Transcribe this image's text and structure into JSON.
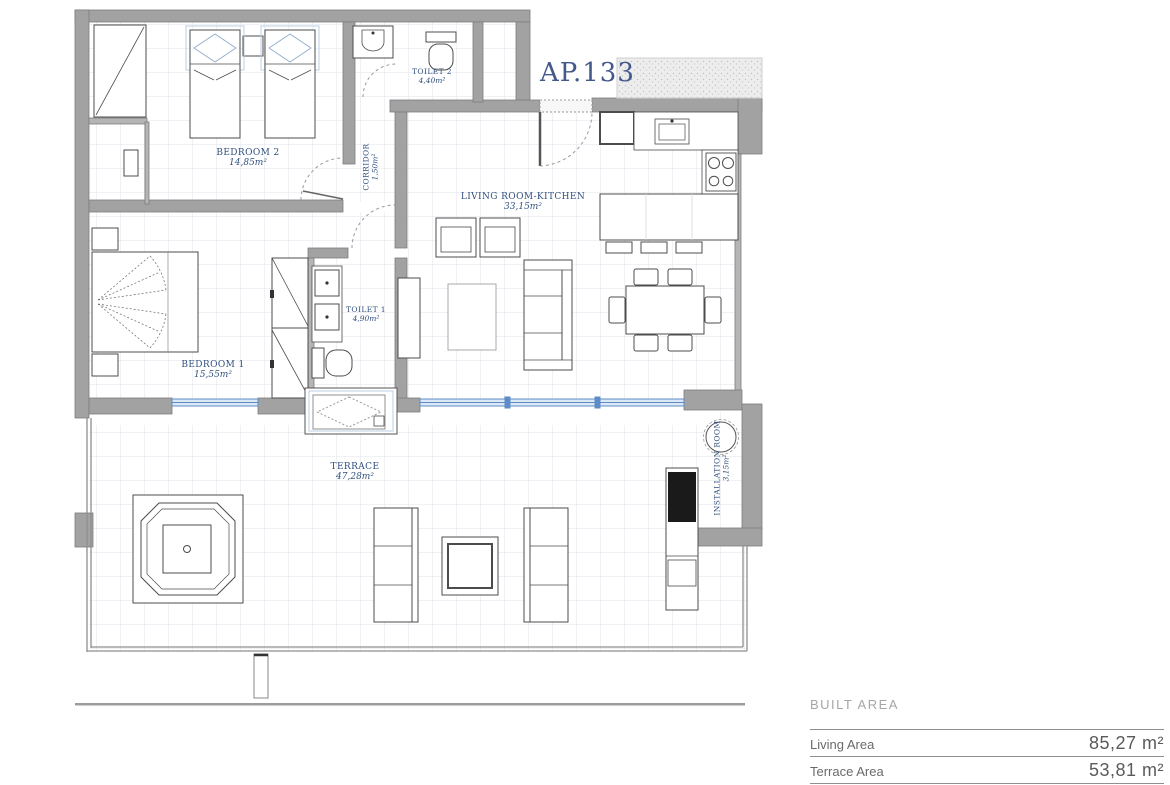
{
  "plan": {
    "apartment_label": "AP.133",
    "rooms": {
      "bedroom2": {
        "name": "BEDROOM 2",
        "area": "14,85m²"
      },
      "toilet2": {
        "name": "TOILET 2",
        "area": "4,40m²"
      },
      "corridor": {
        "name": "CORRIDOR",
        "area": "1,50m²"
      },
      "living": {
        "name": "LIVING ROOM-KITCHEN",
        "area": "33,15m²"
      },
      "bedroom1": {
        "name": "BEDROOM 1",
        "area": "15,55m²"
      },
      "toilet1": {
        "name": "TOILET 1",
        "area": "4,90m²"
      },
      "terrace": {
        "name": "TERRACE",
        "area": "47,28m²"
      },
      "installation": {
        "name": "INSTALLATION ROOM",
        "area": "3,15m²"
      }
    }
  },
  "area_table": {
    "header": "BUILT AREA",
    "rows": [
      {
        "label": "Living Area",
        "value": "85,27 m²"
      },
      {
        "label": "Terrace Area",
        "value": "53,81 m²"
      }
    ]
  },
  "colors": {
    "label_blue": "#31507f",
    "wall_gray": "#a2a2a2",
    "glazing_blue": "#5d8cc7"
  }
}
